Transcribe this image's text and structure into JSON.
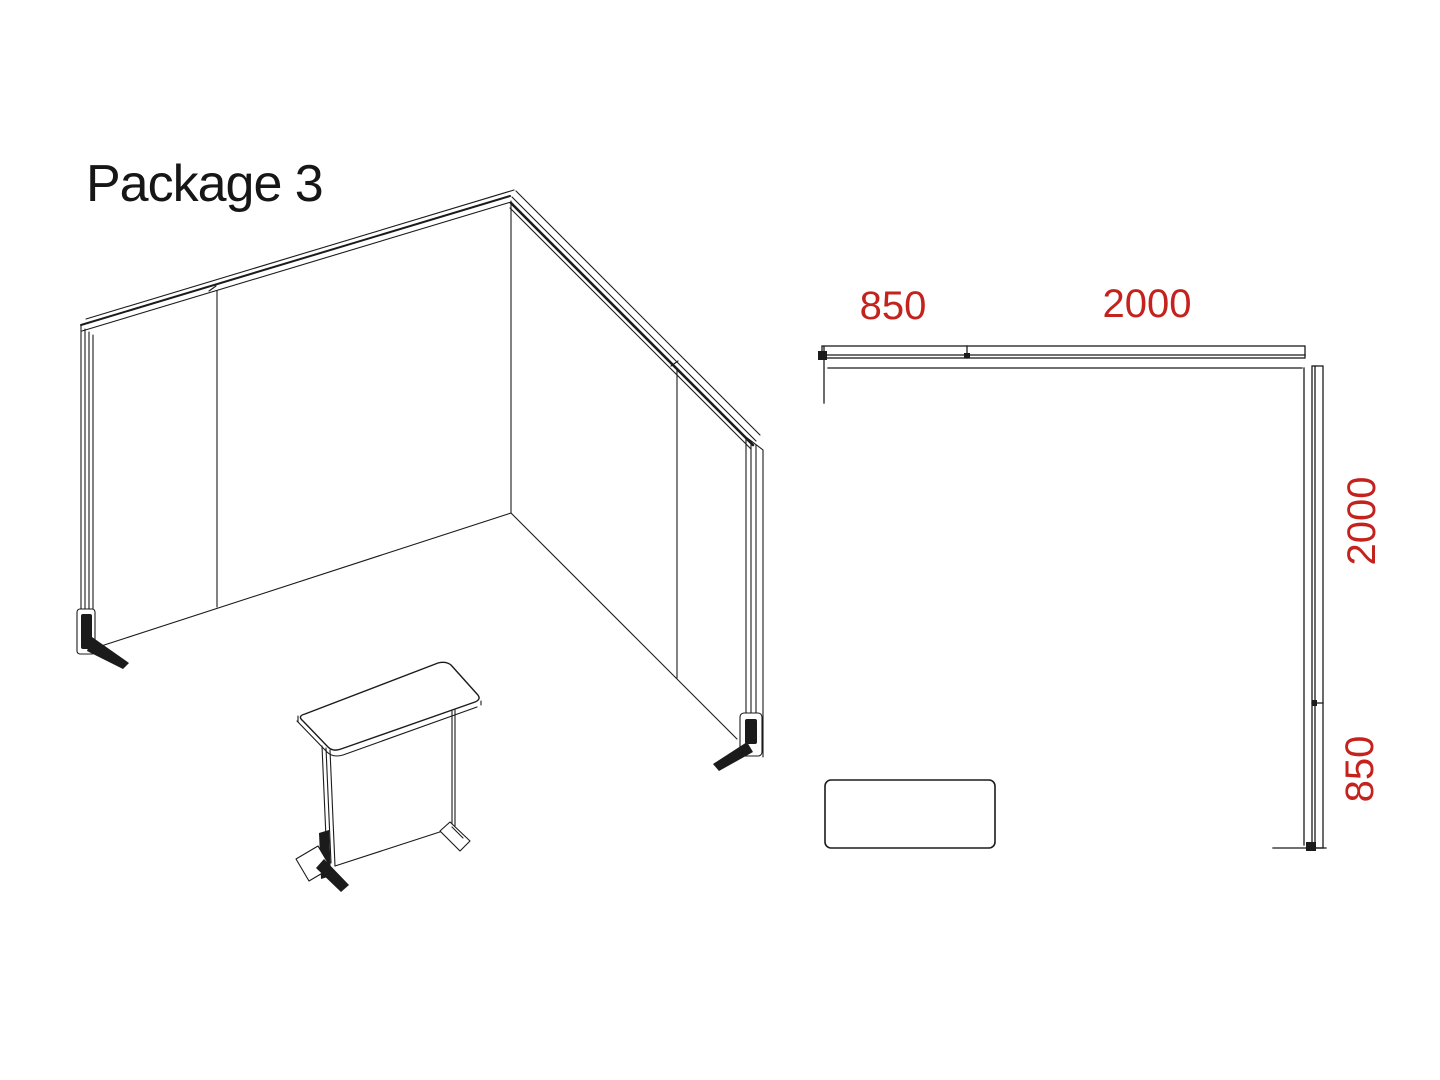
{
  "title": "Package 3",
  "colors": {
    "dimension_text": "#c4221d",
    "line_work": "#1b1b1b",
    "background": "#ffffff"
  },
  "plan_view": {
    "dimensions": [
      {
        "label": "850",
        "edge": "top-left"
      },
      {
        "label": "2000",
        "edge": "top-right"
      },
      {
        "label": "2000",
        "edge": "right-upper"
      },
      {
        "label": "850",
        "edge": "right-lower"
      }
    ]
  }
}
